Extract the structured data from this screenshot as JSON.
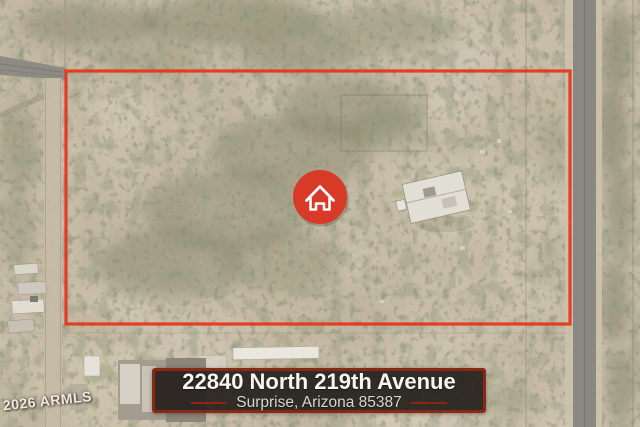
{
  "listing": {
    "address_line1": "22840 North 219th Avenue",
    "address_line2": "Surprise, Arizona 85387"
  },
  "watermark": {
    "text": "© 2026 ARMLS"
  },
  "overlay": {
    "boundary_color": "#e6331a",
    "pin_color": "#d93a27",
    "banner_background": "#282320",
    "banner_border_color": "#8a2817",
    "banner_dash_color": "#9c2412",
    "address_text_color": "#f7f5f2",
    "city_text_color": "#d9d5d0"
  },
  "icons": {
    "home_pin": "house-outline-in-red-circle"
  }
}
